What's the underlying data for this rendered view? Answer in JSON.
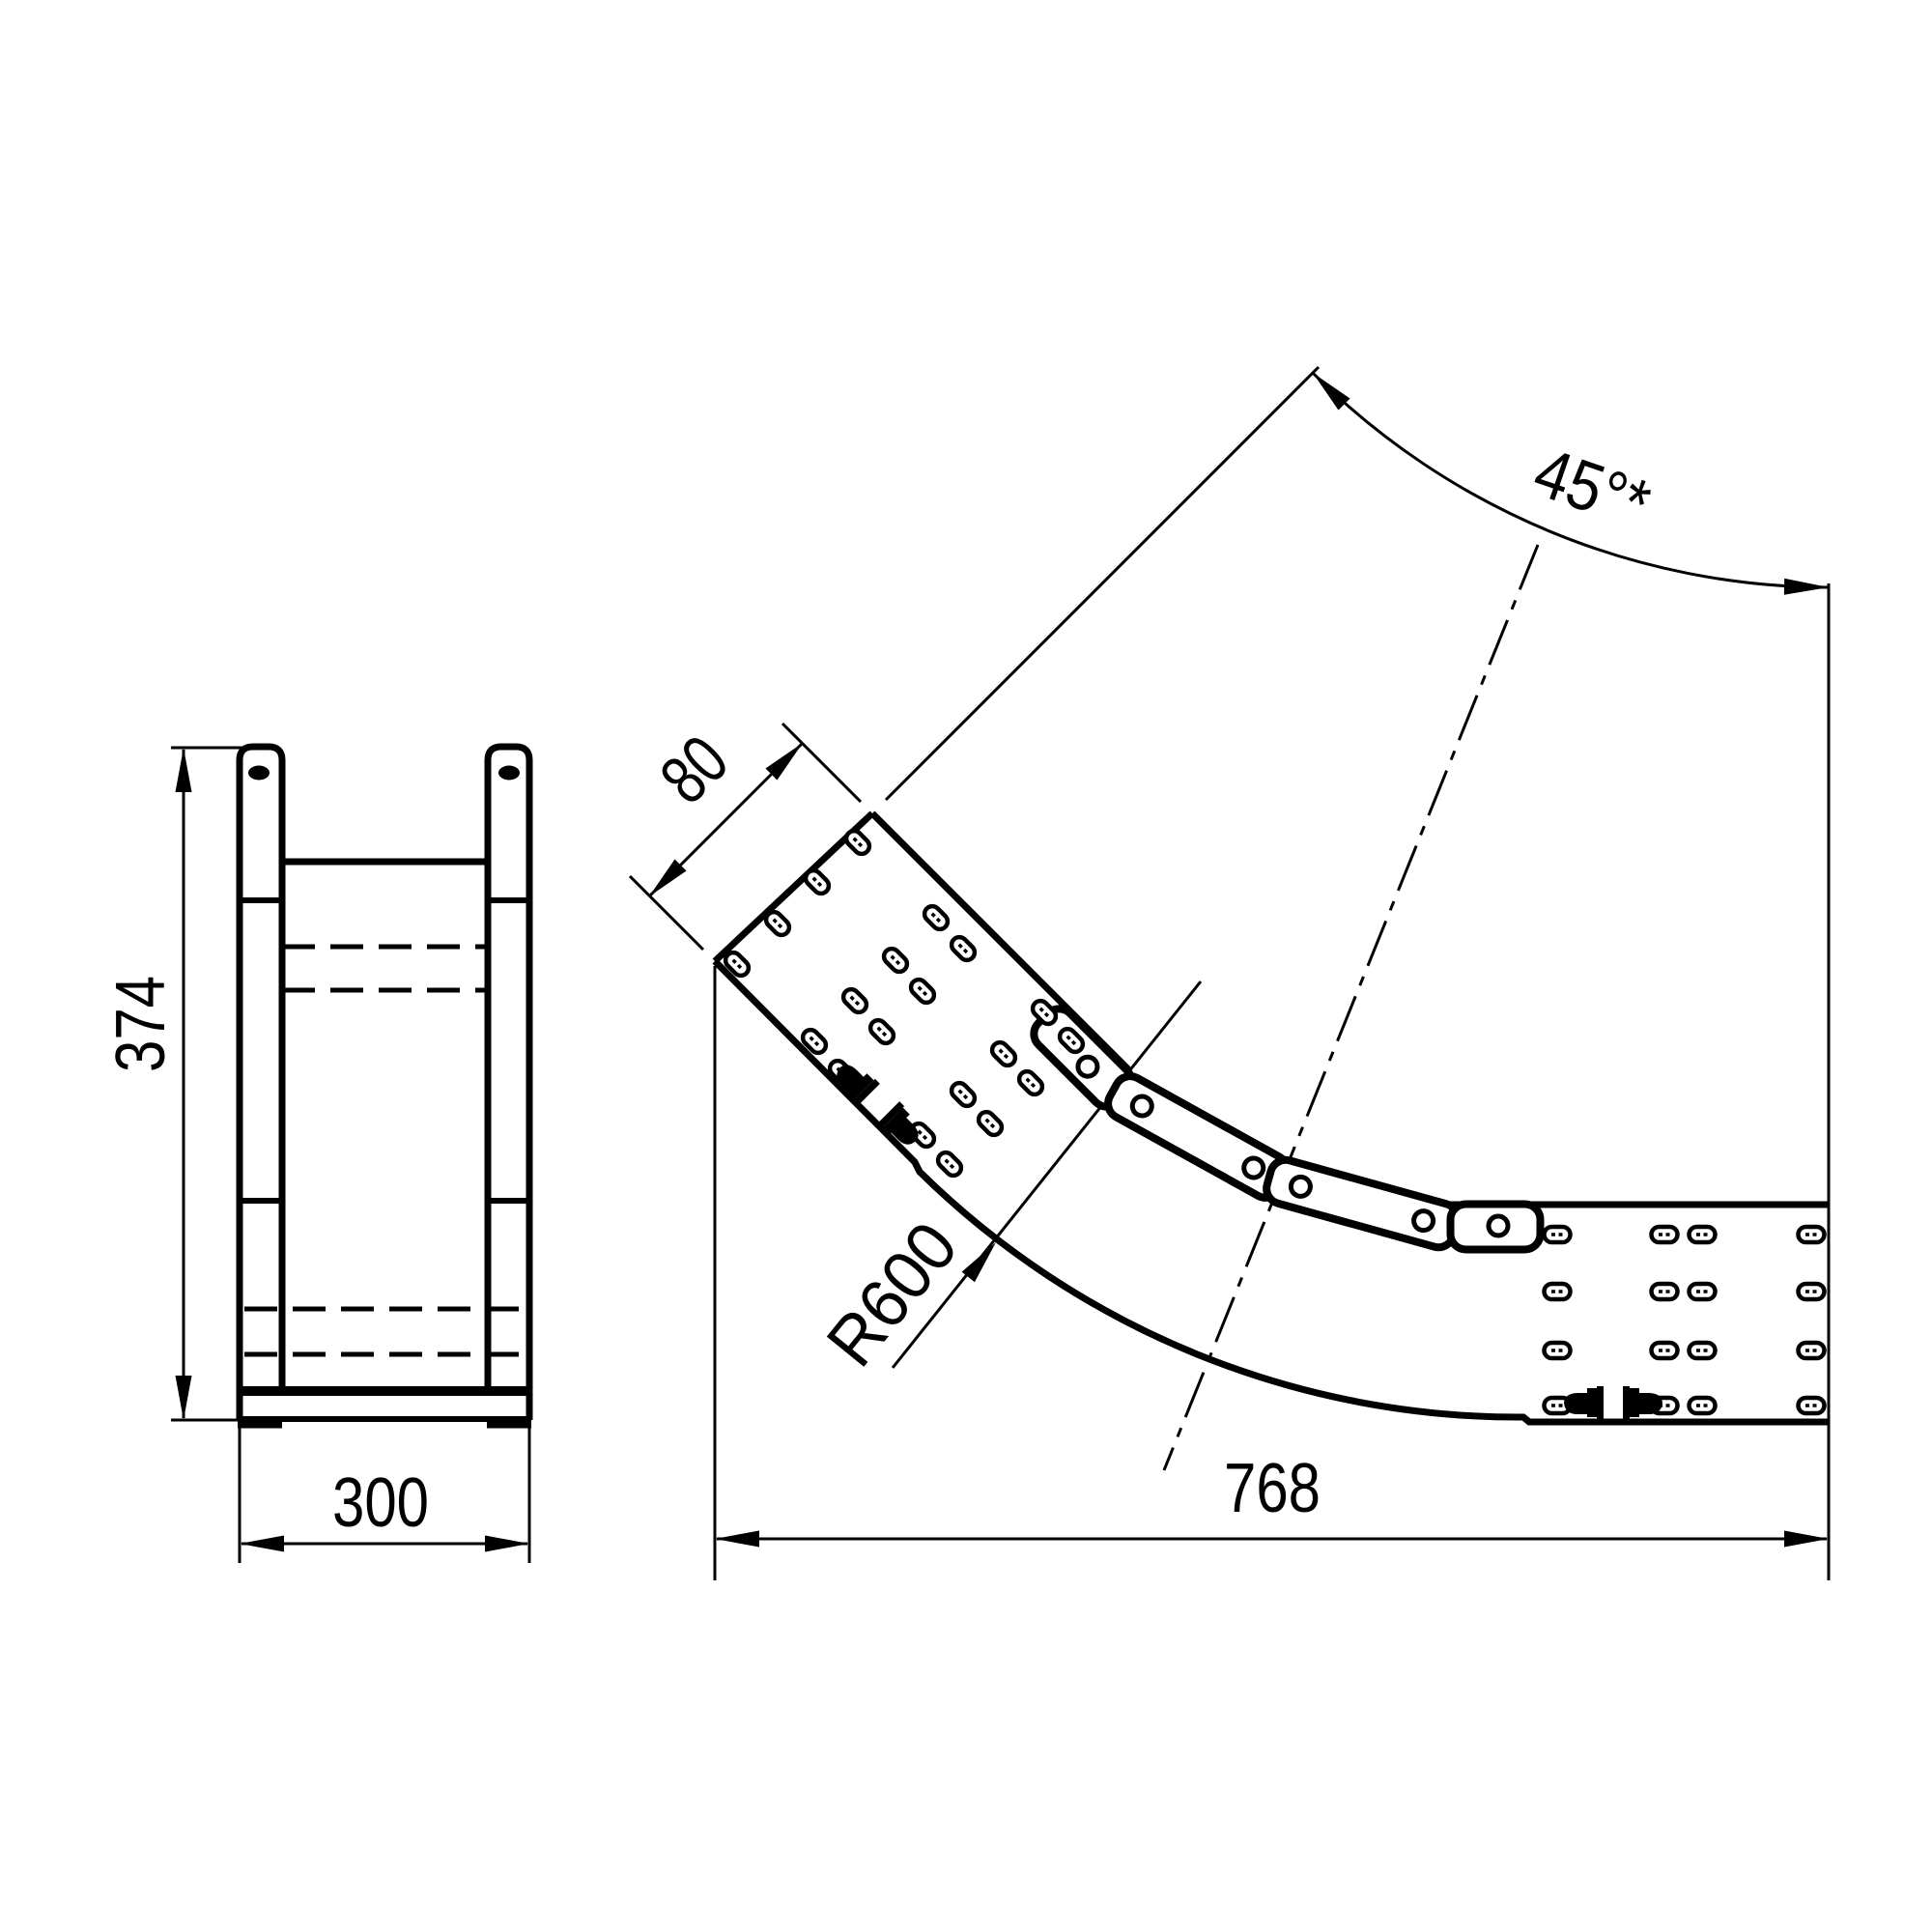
{
  "colors": {
    "ink": "#000000",
    "paper": "#ffffff"
  },
  "front_view": {
    "dim_height": "374",
    "dim_width": "300"
  },
  "side_view": {
    "dim_angle": "45°*",
    "dim_radius": "R600",
    "dim_span": "768",
    "dim_flange": "80"
  }
}
